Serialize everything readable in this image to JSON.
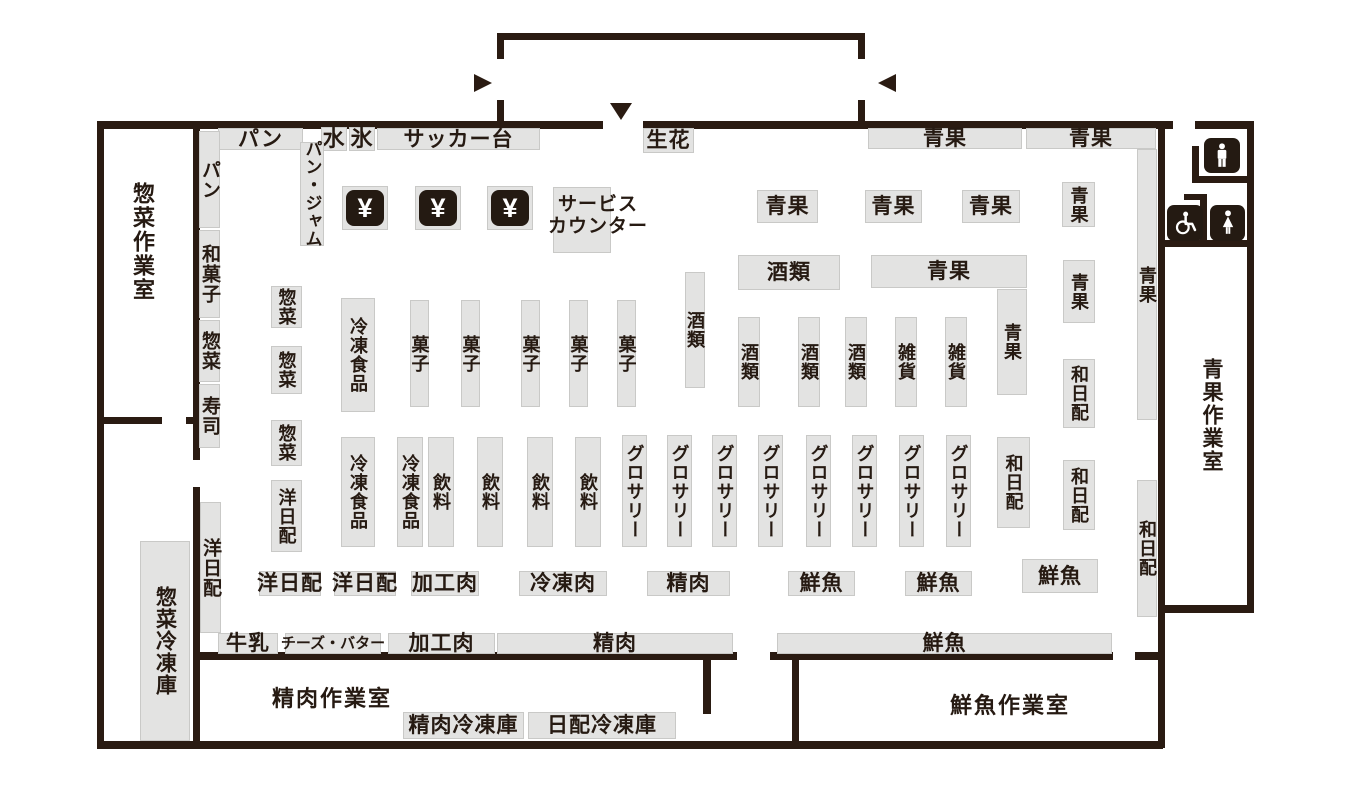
{
  "colors": {
    "wall": "#2a1b12",
    "fixture": "#e3e3e2",
    "icon": "#241a12",
    "ink": "#261a12"
  },
  "icons": {
    "register_glyph": "¥",
    "register": "yen-register-icon",
    "men": "mens-restroom-icon",
    "women": "womens-restroom-icon",
    "wheelchair": "wheelchair-accessible-icon",
    "arrow_in_from_left": "triangle-right-icon",
    "arrow_in_from_right": "triangle-left-icon",
    "arrow_entrance_down": "triangle-down-icon"
  },
  "rooms": {
    "souzai": "惣菜作業室",
    "seiniku": "精肉作業室",
    "sengyo": "鮮魚作業室",
    "seika": "青果作業室"
  },
  "freezer_rooms": {
    "souzai": "惣菜冷凍庫",
    "seiniku": "精肉冷凍庫",
    "nippai": "日配冷凍庫"
  },
  "top_row": [
    "パン",
    "水",
    "氷",
    "サッカー台",
    "生花",
    "青果",
    "青果"
  ],
  "left_strip": [
    "パン",
    "和菓子",
    "惣菜",
    "寿司",
    "洋日配"
  ],
  "pan_jam": "パン・ジャム",
  "service_counter": "サービス\nカウンター",
  "produce_row": [
    "青果",
    "青果",
    "青果",
    "青果"
  ],
  "liquor_shelf": "酒類",
  "produce_wide": "青果",
  "produce_ext": "青果",
  "produce_right": "青果",
  "upper_aisles": [
    "惣菜",
    "惣菜",
    "冷凍食品",
    "菓子",
    "菓子",
    "菓子",
    "菓子",
    "菓子",
    "酒類"
  ],
  "mid_cols": [
    "酒類",
    "酒類",
    "酒類",
    "雑貨",
    "雑貨"
  ],
  "lower_left": [
    "惣菜",
    "洋日配"
  ],
  "lower_aisles": [
    "冷凍食品",
    "冷凍食品",
    "飲料",
    "飲料",
    "飲料",
    "飲料"
  ],
  "grocery": [
    "グロサリー",
    "グロサリー",
    "グロサリー",
    "グロサリー",
    "グロサリー",
    "グロサリー",
    "グロサリー",
    "グロサリー"
  ],
  "wa_nippai": [
    "和日配",
    "和日配",
    "和日配"
  ],
  "right_strip": [
    "青果",
    "和日配"
  ],
  "floor_labels": [
    "洋日配",
    "洋日配",
    "加工肉",
    "冷凍肉",
    "精肉",
    "鮮魚",
    "鮮魚",
    "鮮魚"
  ],
  "wall_shelves": [
    "牛乳",
    "チーズ・バター",
    "加工肉",
    "精肉",
    "鮮魚"
  ]
}
